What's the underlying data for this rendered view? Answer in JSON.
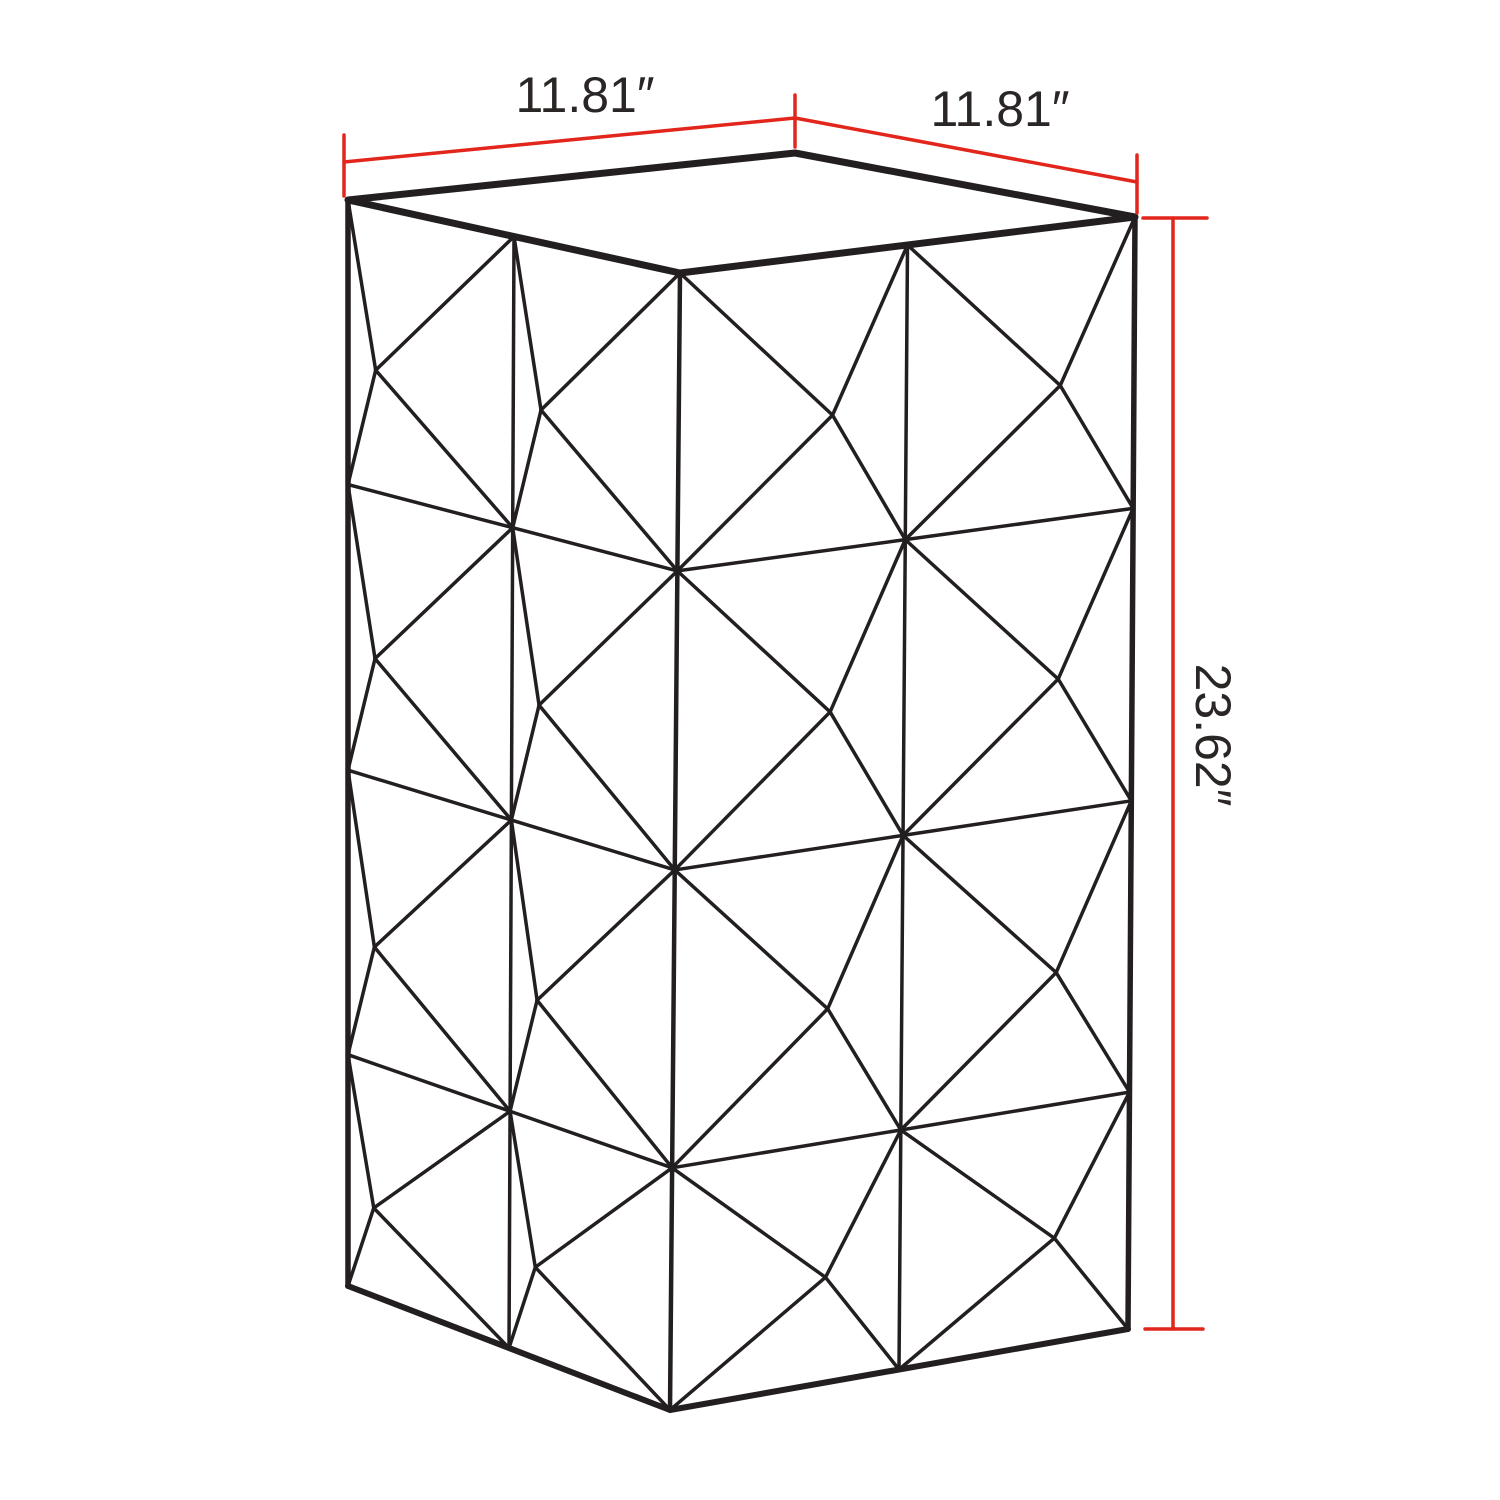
{
  "diagram": {
    "labels": {
      "width": "11.81″",
      "depth": "11.81″",
      "height": "23.62″"
    },
    "colors": {
      "line": "#231f20",
      "dimension": "#e2261c",
      "text": "#2a2625",
      "background": "#ffffff"
    },
    "box": {
      "top_face": {
        "left": [
          348,
          200
        ],
        "back": [
          795,
          153
        ],
        "right": [
          1135,
          217
        ],
        "front": [
          680,
          273
        ]
      },
      "bottom": {
        "left": [
          348,
          1286
        ],
        "front": [
          670,
          1410
        ],
        "right": [
          1128,
          1329
        ]
      }
    },
    "pattern": {
      "col_fractions": [
        0,
        0.5,
        1
      ],
      "row_fractions": [
        0,
        0.262,
        0.525,
        0.787,
        1
      ],
      "apex_offset_left_face": [
        -55,
        8
      ],
      "apex_offset_right_face": [
        40,
        8
      ],
      "line_width": 3.5
    },
    "edge_widths": {
      "top_face": 7,
      "side": 5.5,
      "bottom": 6,
      "front": 4.5
    },
    "dimension_style": {
      "line_width": 3.5,
      "font_size": 50
    },
    "dimension_lines": {
      "width": {
        "line": [
          [
            344,
            162
          ],
          [
            795,
            118
          ]
        ],
        "ticks": [
          [
            [
              344,
              135
            ],
            [
              344,
              196
            ]
          ],
          [
            [
              795,
              95
            ],
            [
              795,
              147
            ]
          ]
        ],
        "label_pos": [
          585,
          112
        ],
        "rotation": 0
      },
      "depth": {
        "line": [
          [
            795,
            118
          ],
          [
            1137,
            182
          ]
        ],
        "ticks": [
          [
            [
              1137,
              155
            ],
            [
              1137,
              213
            ]
          ]
        ],
        "label_pos": [
          1000,
          126
        ],
        "rotation": 0
      },
      "height": {
        "line": [
          [
            1173,
            218
          ],
          [
            1173,
            1329
          ]
        ],
        "ticks": [
          [
            [
              1143,
              218
            ],
            [
              1207,
              218
            ]
          ],
          [
            [
              1145,
              1329
            ],
            [
              1203,
              1329
            ]
          ]
        ],
        "label_pos": [
          1196,
          735
        ],
        "rotation": 90
      }
    }
  }
}
